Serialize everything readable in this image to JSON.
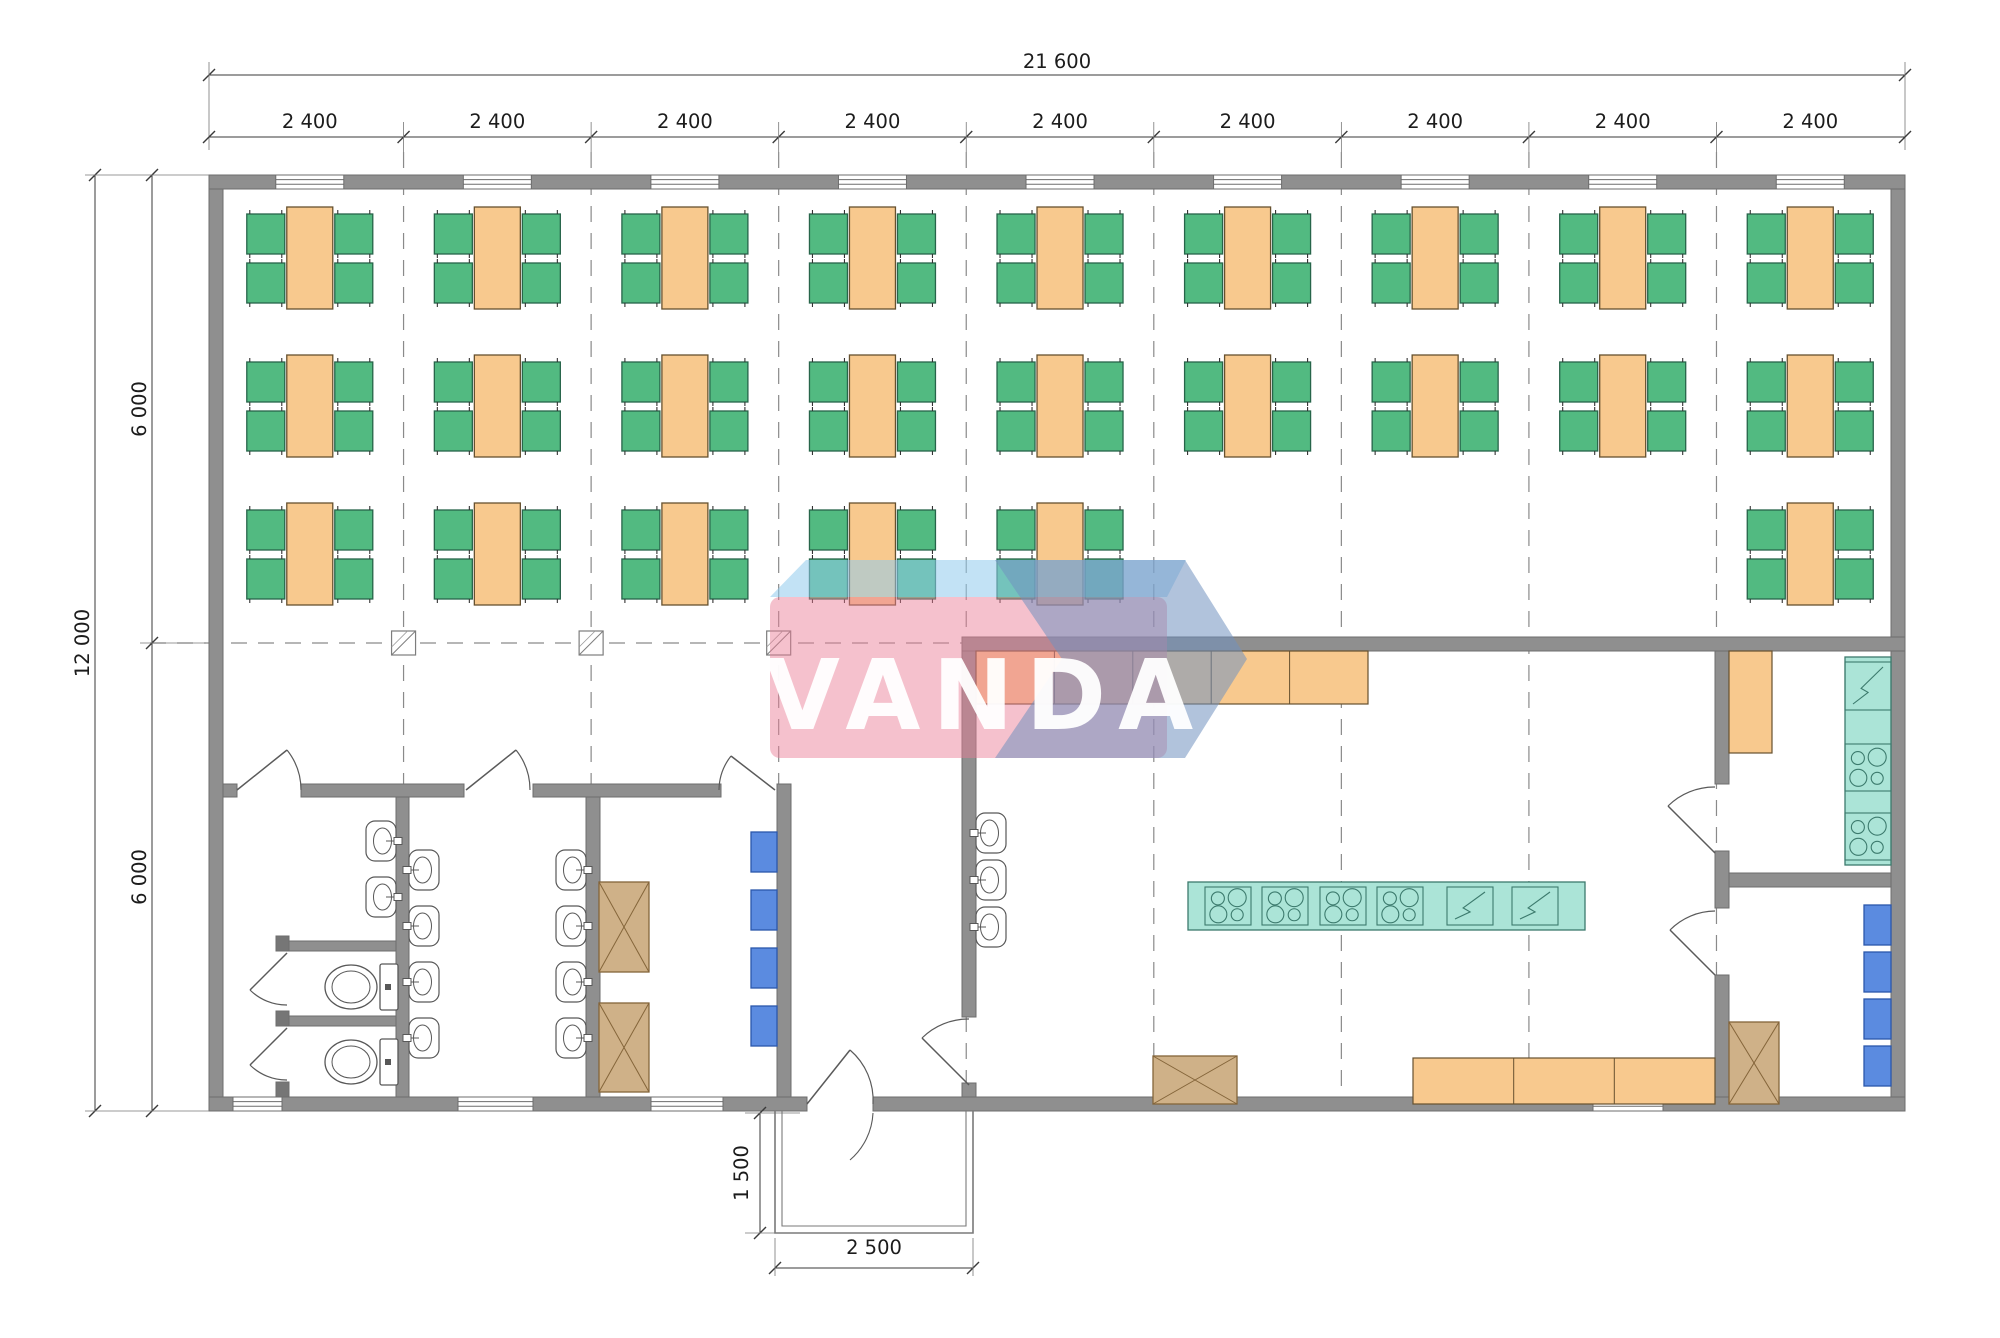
{
  "title": "canteen-module-floor-plan",
  "watermark": {
    "text": "VANDA",
    "pink": "rgba(235,126,150,0.48)",
    "top_band": "rgba(144,203,236,0.55)",
    "arrow": "rgba(113,146,192,0.55)",
    "text_color": "rgba(255,255,255,0.95)"
  },
  "dimensions": {
    "top_total": "21 600",
    "bays": [
      "2 400",
      "2 400",
      "2 400",
      "2 400",
      "2 400",
      "2 400",
      "2 400",
      "2 400",
      "2 400"
    ],
    "left_total": "12 000",
    "left_upper": "6 000",
    "left_lower": "6 000",
    "porch_depth": "1 500",
    "porch_width": "2 500"
  },
  "colors": {
    "wall": "#8f8f8f",
    "wall_stroke": "#6d6d6d",
    "wall_cap": "#767676",
    "table": "#f8c98e",
    "table_stroke": "#66512f",
    "chair": "#52ba81",
    "chair_stroke": "#27654a",
    "teal": "#abe4d7",
    "teal_stroke": "#3c7a6d",
    "tan": "#cfb188",
    "tan_stroke": "#84653a",
    "blue": "#5b8be0",
    "blue_stroke": "#2b57ab",
    "fixture": "#ffffff",
    "fixture_stroke": "#585858",
    "dim_line": "#3a3a3a",
    "ext_line": "#777777",
    "grid": "#8a8a8a",
    "porch_line": "#7a7a7a"
  },
  "inventory": {
    "dining_table_rows_bays": [
      [
        0,
        1,
        2,
        3,
        4,
        5,
        6,
        7,
        8
      ],
      [
        0,
        1,
        2,
        3,
        4,
        5,
        6,
        7,
        8
      ],
      [
        0,
        1,
        2,
        3,
        4,
        8
      ]
    ],
    "dining_tables": 24,
    "chairs_per_table": 4,
    "toilets": 2,
    "toilet_stalls": 2,
    "wall_sinks_washroom_left": 2,
    "wall_sinks_washroom_middle": 8,
    "wall_sinks_kitchen": 3,
    "island_cooktops": 4,
    "island_sinks": 2,
    "wall_counter_cooktops": 2,
    "wall_counter_sink": 1,
    "blue_lockers": 8,
    "tan_crossed_cabinets": 5,
    "serving_counter_segments": 5,
    "base_counter_segments": 3,
    "windows_top": 9,
    "windows_bottom": 4,
    "entrance_porch": 1
  }
}
